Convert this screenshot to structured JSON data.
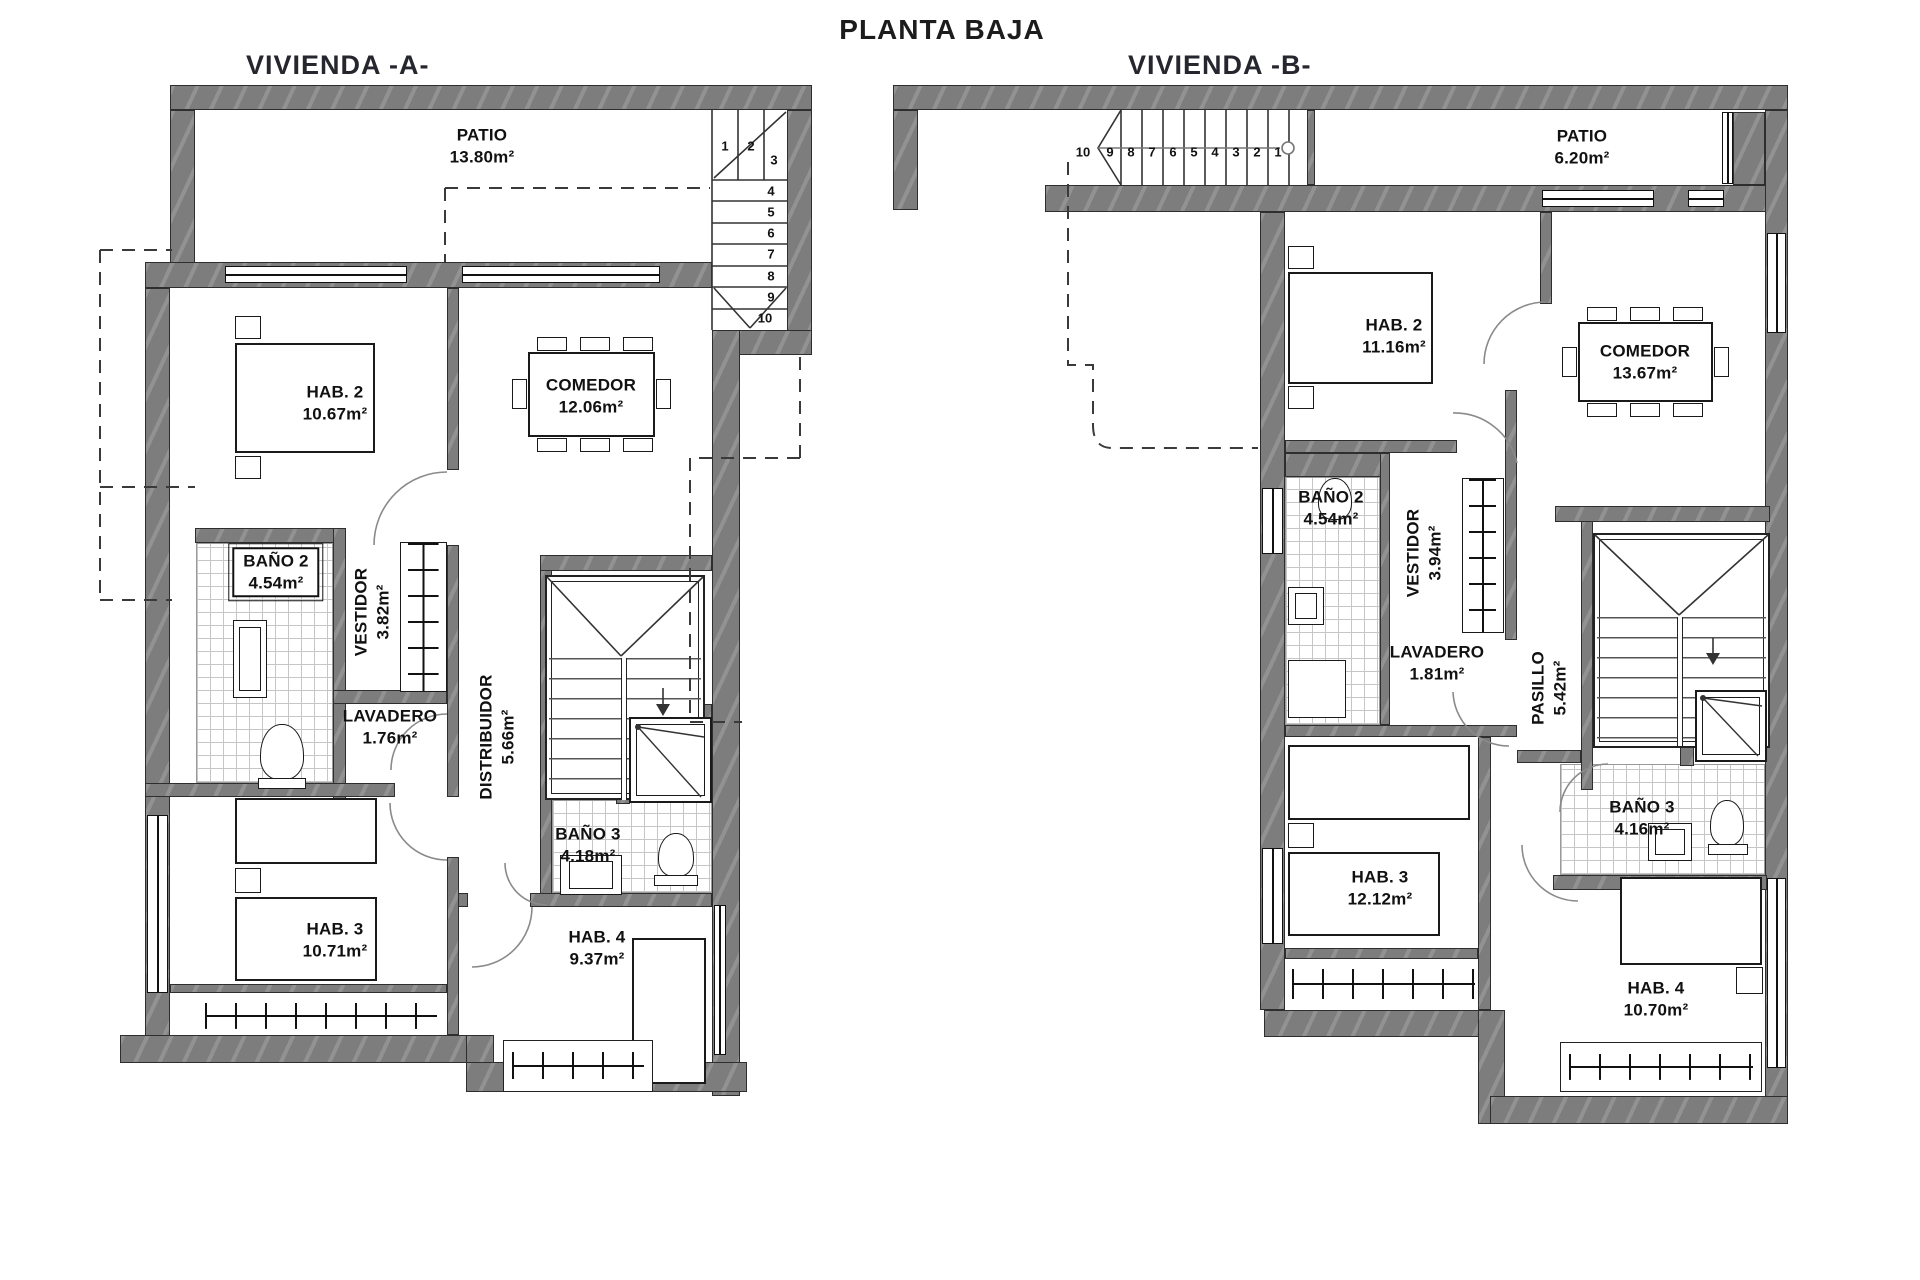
{
  "title": "PLANTA BAJA",
  "colors": {
    "wall": "#7d7d7d",
    "line": "#1a1a1a",
    "tile_grid": "#c6c6c6"
  },
  "vivienda_a": {
    "name": "VIVIENDA -A-",
    "rooms": {
      "patio": {
        "name": "PATIO",
        "area": "13.80m²"
      },
      "hab2": {
        "name": "HAB. 2",
        "area": "10.67m²"
      },
      "comedor": {
        "name": "COMEDOR",
        "area": "12.06m²"
      },
      "bano2": {
        "name": "BAÑO 2",
        "area": "4.54m²"
      },
      "vestidor": {
        "name": "VESTIDOR",
        "area": "3.82m²"
      },
      "lavadero": {
        "name": "LAVADERO",
        "area": "1.76m²"
      },
      "distribuidor": {
        "name": "DISTRIBUIDOR",
        "area": "5.66m²"
      },
      "bano3": {
        "name": "BAÑO 3",
        "area": "4.18m²"
      },
      "hab3": {
        "name": "HAB. 3",
        "area": "10.71m²"
      },
      "hab4": {
        "name": "HAB. 4",
        "area": "9.37m²"
      }
    },
    "stairs": [
      "1",
      "2",
      "3",
      "4",
      "5",
      "6",
      "7",
      "8",
      "9",
      "10"
    ]
  },
  "vivienda_b": {
    "name": "VIVIENDA -B-",
    "rooms": {
      "patio": {
        "name": "PATIO",
        "area": "6.20m²"
      },
      "hab2": {
        "name": "HAB. 2",
        "area": "11.16m²"
      },
      "comedor": {
        "name": "COMEDOR",
        "area": "13.67m²"
      },
      "bano2": {
        "name": "BAÑO 2",
        "area": "4.54m²"
      },
      "vestidor": {
        "name": "VESTIDOR",
        "area": "3.94m²"
      },
      "lavadero": {
        "name": "LAVADERO",
        "area": "1.81m²"
      },
      "pasillo": {
        "name": "PASILLO",
        "area": "5.42m²"
      },
      "bano3": {
        "name": "BAÑO 3",
        "area": "4.16m²"
      },
      "hab3": {
        "name": "HAB. 3",
        "area": "12.12m²"
      },
      "hab4": {
        "name": "HAB. 4",
        "area": "10.70m²"
      }
    },
    "stairs": [
      "10",
      "9",
      "8",
      "7",
      "6",
      "5",
      "4",
      "3",
      "2",
      "1"
    ]
  }
}
